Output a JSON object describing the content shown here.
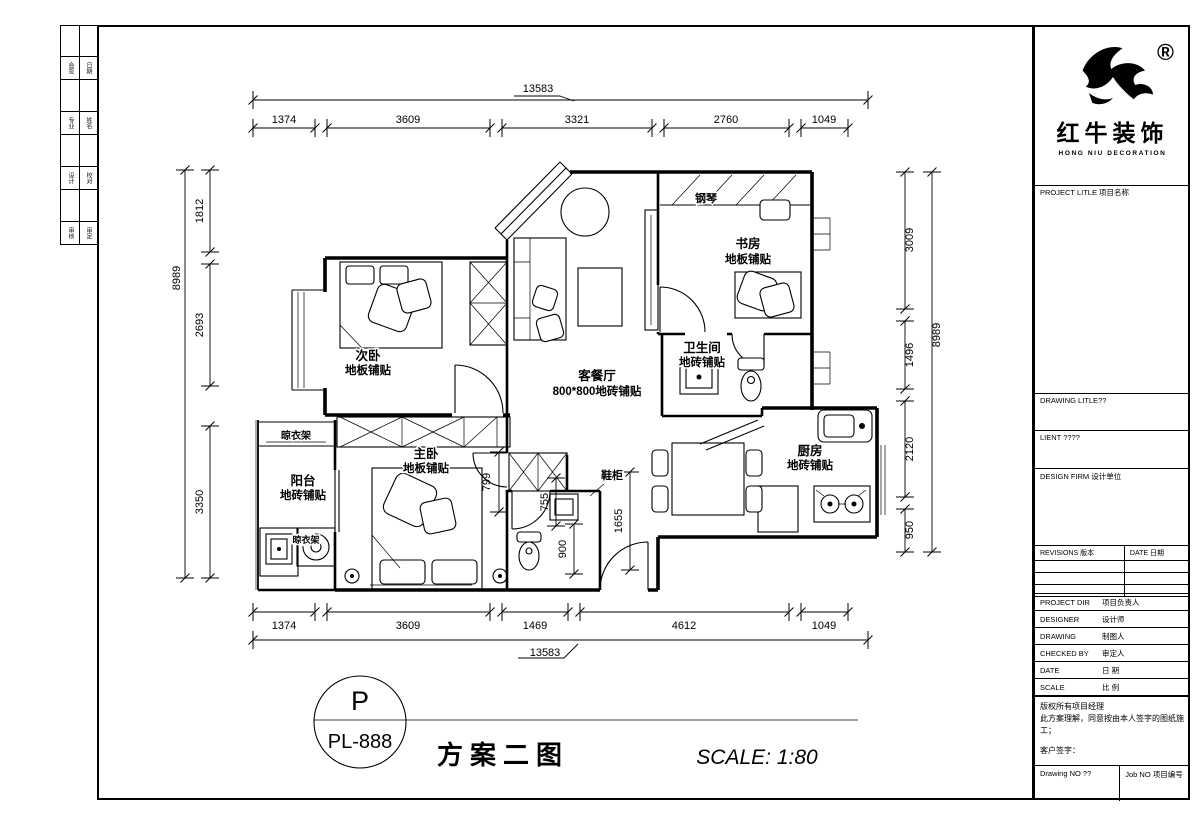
{
  "sign_strip": [
    "会签",
    "日期",
    "专业",
    "姓名",
    "设计",
    "校对",
    "审核",
    "审定"
  ],
  "brand": {
    "cn": "红牛装饰",
    "en": "HONG NIU DECORATION",
    "reg": "®"
  },
  "titleblock": {
    "project_title": "PROJECT LITLE 项目名称",
    "drawing_title": "DRAWING LITLE??",
    "client": "LIENT ????",
    "design_firm": "DESIGN FIRM 设计单位",
    "revisions": "REVISIONS 版本",
    "rev_date": "DATE 日期",
    "rows": [
      {
        "en": "PROJECT DIR",
        "cn": "项目负责人"
      },
      {
        "en": "DESIGNER",
        "cn": "设计师"
      },
      {
        "en": "DRAWING",
        "cn": "制图人"
      },
      {
        "en": "CHECKED BY",
        "cn": "审定人"
      },
      {
        "en": "DATE",
        "cn": "日 期"
      },
      {
        "en": "SCALE",
        "cn": "比 例"
      }
    ],
    "note1": "版权所有项目经理",
    "note2": "此方案理解，同意按由本人签字的图纸施工；",
    "note3": "客户签字：",
    "drawing_no": "Drawing NO ??",
    "job_no": "Job NO 项目编号"
  },
  "plan": {
    "rooms": [
      {
        "name": "次卧",
        "finish": "地板铺贴"
      },
      {
        "name": "主卧",
        "finish": "地板铺贴"
      },
      {
        "name": "阳台",
        "finish": "地砖铺贴"
      },
      {
        "name": "客餐厅",
        "finish": "800*800地砖铺贴"
      },
      {
        "name": "卫生间",
        "finish": "地砖铺贴"
      },
      {
        "name": "厨房",
        "finish": "地砖铺贴"
      },
      {
        "name": "书房",
        "finish": "地板铺贴"
      }
    ],
    "annot": {
      "piano": "钢琴",
      "shoe": "鞋柜",
      "rack1": "晾衣架",
      "rack2": "晾衣架"
    },
    "dims": {
      "top_total": "13583",
      "top": [
        "1374",
        "3609",
        "3321",
        "2760",
        "1049"
      ],
      "bottom_total": "13583",
      "bottom": [
        "1374",
        "3609",
        "1469",
        "4612",
        "1049"
      ],
      "left_total": "8989",
      "left": [
        "1812",
        "2693",
        "3350"
      ],
      "right_total": "8989",
      "right": [
        "3009",
        "1496",
        "2120",
        "950"
      ],
      "inner": [
        "799",
        "755",
        "900",
        "1655"
      ]
    }
  },
  "footer": {
    "tag_top": "P",
    "tag_no": "PL-888",
    "title": "方案二图",
    "scale": "SCALE: 1:80"
  }
}
